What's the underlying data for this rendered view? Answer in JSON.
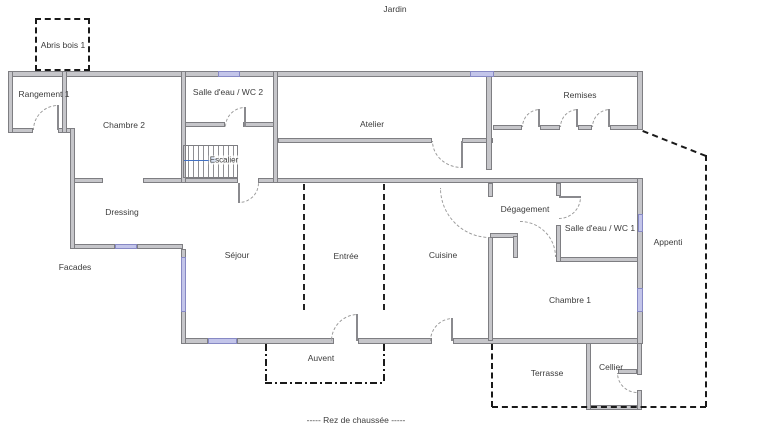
{
  "plan_title": "----- Rez de chaussée -----",
  "labels": {
    "jardin": "Jardin",
    "abris_bois": "Abris bois 1",
    "rangement": "Rangement 1",
    "chambre2": "Chambre 2",
    "sde_wc2": "Salle d'eau / WC 2",
    "atelier": "Atelier",
    "remises": "Remises",
    "escalier": "Escalier",
    "dressing": "Dressing",
    "facades": "Facades",
    "sejour": "Séjour",
    "entree": "Entrée",
    "cuisine": "Cuisine",
    "degagement": "Dégagement",
    "sde_wc1": "Salle d'eau / WC 1",
    "appenti": "Appenti",
    "chambre1": "Chambre 1",
    "auvent": "Auvent",
    "terrasse": "Terrasse",
    "cellier": "Cellier"
  },
  "colors": {
    "wall_fill": "#c6c6ca",
    "wall_outline": "#7e7e82",
    "window_fill": "#c3c5ea",
    "window_outline": "#8789c4",
    "stair_arrow": "#4472c4",
    "boundary_dash": "#1a1a1a",
    "door_arc": "#9a9a9a",
    "label_text": "#3c3c3c"
  }
}
